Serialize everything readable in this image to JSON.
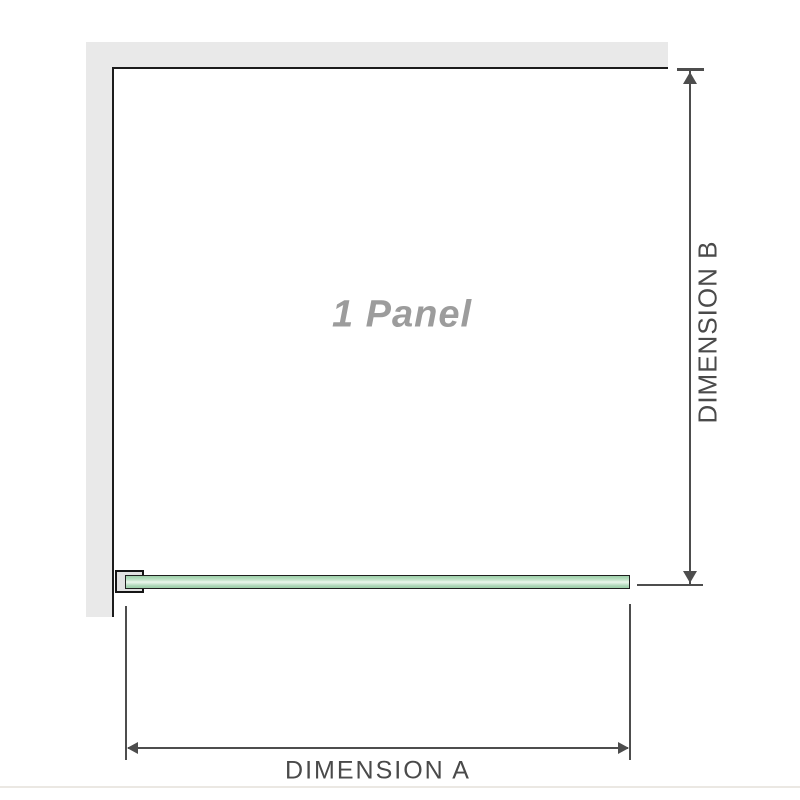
{
  "diagram": {
    "panel_label": "1 Panel",
    "dimension_a": {
      "label": "DIMENSION A"
    },
    "dimension_b": {
      "label": "DIMENSION B"
    },
    "colors": {
      "wall_fill": "#e9e9e9",
      "wall_edge": "#1c1c1c",
      "dim_line": "#4d4d4d",
      "dim_text": "#4a4a4a",
      "panel_text": "#9c9c9c",
      "glass_border": "#1f1f1f",
      "glass_green": "#a8d4b3",
      "glass_highlight": "#ecf7ed",
      "bracket_fill": "#e2e2e2",
      "baseline": "#ebe8e3"
    }
  }
}
